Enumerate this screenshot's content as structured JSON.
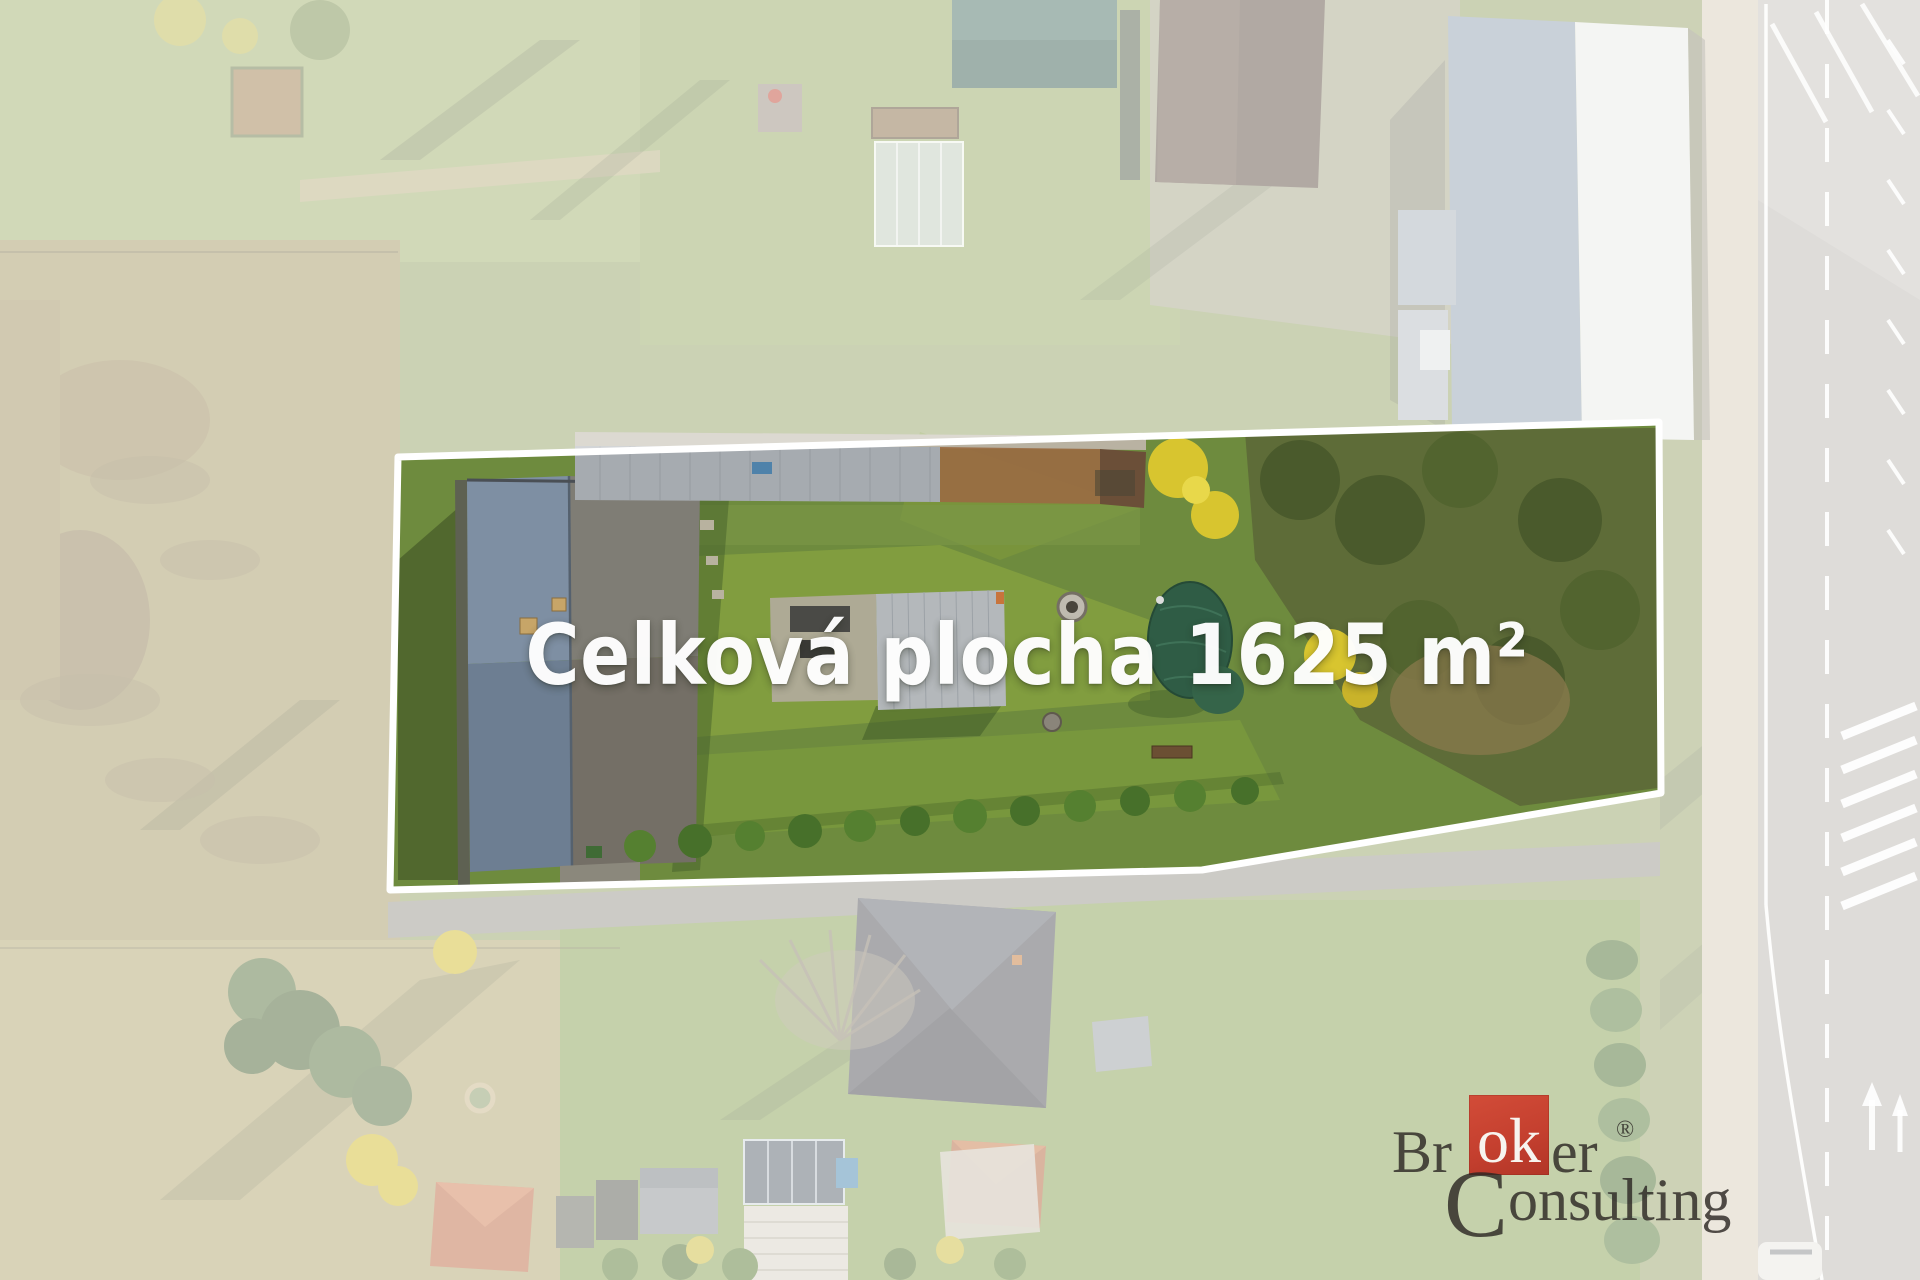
{
  "overlay": {
    "area_label": "Celková plocha 1625 m²"
  },
  "watermark": {
    "word1_prefix": "Br",
    "word1_highlight": "ok",
    "word1_suffix": "er",
    "registered_mark": "®",
    "word2_initial": "C",
    "word2_rest": "onsulting"
  },
  "colors": {
    "boundary_outline": "#ffffff",
    "outside_wash": "rgba(255,255,255,0.5)",
    "watermark_red": "#c5402f",
    "watermark_text": "#2c2723",
    "label_text": "#ffffff"
  }
}
